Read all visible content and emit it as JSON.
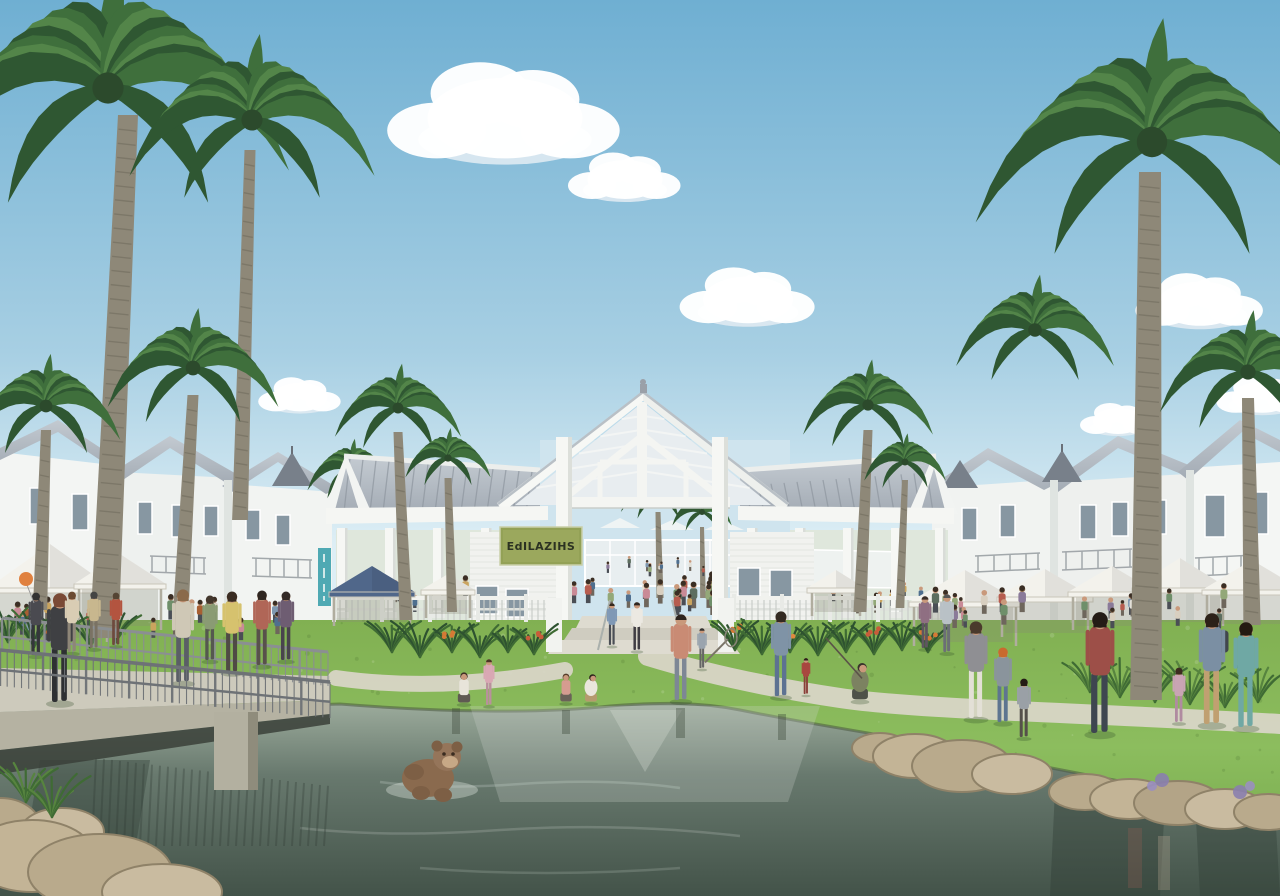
{
  "sign": {
    "text": "EdILAZIHS",
    "bg": "#93a156",
    "border": "#6d7a3c",
    "text_color": "#2c3222"
  },
  "banner": {
    "color": "#4fa9b3"
  },
  "palette": {
    "sky_top": "#6fafd2",
    "sky_mid": "#a7cfe3",
    "sky_low": "#ddeef5",
    "cloud": "#ffffff",
    "cloud_shade": "#dfeaf2",
    "grass_light": "#8cbd5e",
    "grass": "#6fa348",
    "grass_dark": "#56893a",
    "path": "#d8d5c6",
    "water_top": "#a3b2a2",
    "water_mid": "#68796e",
    "water_low": "#435349",
    "roof": "#b4bbc3",
    "roof_seam": "#8e969f",
    "wall_white": "#f5f6f4",
    "wall_shade": "#e2e6e3",
    "window": "#8797a2",
    "trunk": "#8e8878",
    "trunk_dark": "#6f6a5c",
    "palm_dark": "#2f5732",
    "palm_mid": "#3f6f3c",
    "palm_light": "#538549",
    "tent_white": "#f3f2ec",
    "tent_blue": "#50678a",
    "rock": "#b9aa8c",
    "rock_dark": "#8f8268",
    "concrete": "#cdcabc",
    "railing": "#7e8286",
    "skin": "#c9997b"
  },
  "clouds": [
    {
      "cx": 505,
      "cy": 115,
      "s": 1.55
    },
    {
      "cx": 625,
      "cy": 178,
      "s": 0.75
    },
    {
      "cx": 748,
      "cy": 298,
      "s": 0.9
    },
    {
      "cx": 300,
      "cy": 396,
      "s": 0.55
    },
    {
      "cx": 1200,
      "cy": 302,
      "s": 0.85
    },
    {
      "cx": 1262,
      "cy": 396,
      "s": 0.6
    },
    {
      "cx": 1118,
      "cy": 420,
      "s": 0.5
    }
  ],
  "palms": [
    {
      "cx": 108,
      "cy": 88,
      "r": 195,
      "trunk": {
        "tx": 128,
        "ty": 115,
        "bx": 104,
        "by": 638,
        "w": 20
      },
      "layer": "front"
    },
    {
      "cx": 252,
      "cy": 120,
      "r": 132,
      "trunk": {
        "tx": 250,
        "ty": 150,
        "bx": 240,
        "by": 520,
        "w": 11
      },
      "layer": "front"
    },
    {
      "cx": 193,
      "cy": 368,
      "r": 92,
      "trunk": {
        "tx": 193,
        "ty": 395,
        "bx": 180,
        "by": 625,
        "w": 11
      },
      "layer": "front"
    },
    {
      "cx": 46,
      "cy": 406,
      "r": 80,
      "trunk": {
        "tx": 46,
        "ty": 430,
        "bx": 40,
        "by": 610,
        "w": 10
      },
      "layer": "front"
    },
    {
      "cx": 398,
      "cy": 408,
      "r": 68,
      "trunk": {
        "tx": 398,
        "ty": 432,
        "bx": 406,
        "by": 620,
        "w": 9
      },
      "layer": "front"
    },
    {
      "cx": 448,
      "cy": 458,
      "r": 46,
      "trunk": {
        "tx": 448,
        "ty": 478,
        "bx": 452,
        "by": 612,
        "w": 7
      },
      "layer": "front"
    },
    {
      "cx": 868,
      "cy": 405,
      "r": 70,
      "trunk": {
        "tx": 868,
        "ty": 430,
        "bx": 860,
        "by": 612,
        "w": 9
      },
      "layer": "front"
    },
    {
      "cx": 905,
      "cy": 462,
      "r": 44,
      "trunk": {
        "tx": 905,
        "ty": 480,
        "bx": 900,
        "by": 608,
        "w": 6
      },
      "layer": "front"
    },
    {
      "cx": 1152,
      "cy": 142,
      "r": 190,
      "trunk": {
        "tx": 1150,
        "ty": 172,
        "bx": 1146,
        "by": 700,
        "w": 22
      },
      "layer": "front"
    },
    {
      "cx": 1248,
      "cy": 372,
      "r": 95,
      "trunk": {
        "tx": 1248,
        "ty": 398,
        "bx": 1252,
        "by": 625,
        "w": 12
      },
      "layer": "front"
    },
    {
      "cx": 1035,
      "cy": 330,
      "r": 85,
      "trunk": null,
      "layer": "backA"
    },
    {
      "cx": 352,
      "cy": 470,
      "r": 48,
      "trunk": null,
      "layer": "backB"
    },
    {
      "cx": 658,
      "cy": 495,
      "r": 40,
      "trunk": {
        "tx": 658,
        "ty": 512,
        "bx": 660,
        "by": 598,
        "w": 5
      },
      "layer": "mid"
    },
    {
      "cx": 702,
      "cy": 512,
      "r": 32,
      "trunk": {
        "tx": 702,
        "ty": 527,
        "bx": 703,
        "by": 598,
        "w": 4
      },
      "layer": "mid"
    }
  ],
  "tents": [
    {
      "cx": 50,
      "y": 588,
      "w": 124,
      "rise": 44,
      "legH": 54,
      "row": "left"
    },
    {
      "cx": 120,
      "y": 584,
      "w": 92,
      "rise": 30,
      "legH": 46,
      "row": "left"
    },
    {
      "cx": 372,
      "y": 592,
      "w": 86,
      "rise": 26,
      "legH": 34,
      "row": "left",
      "color": "#50678a"
    },
    {
      "cx": 448,
      "y": 590,
      "w": 54,
      "rise": 16,
      "legH": 28,
      "row": "left"
    },
    {
      "cx": 836,
      "y": 588,
      "w": 58,
      "rise": 18,
      "legH": 28,
      "row": "right"
    },
    {
      "cx": 965,
      "y": 602,
      "w": 112,
      "rise": 32,
      "legH": 44,
      "row": "right"
    },
    {
      "cx": 1045,
      "y": 597,
      "w": 96,
      "rise": 28,
      "legH": 40,
      "row": "right"
    },
    {
      "cx": 1112,
      "y": 592,
      "w": 88,
      "rise": 26,
      "legH": 38,
      "row": "right"
    },
    {
      "cx": 1180,
      "y": 588,
      "w": 96,
      "rise": 30,
      "legH": 38,
      "row": "right"
    },
    {
      "cx": 1252,
      "y": 590,
      "w": 100,
      "rise": 30,
      "legH": 38,
      "row": "right"
    }
  ],
  "crowds": [
    {
      "layer": "distant",
      "x": 598,
      "y": 560,
      "w": 124,
      "h": 18,
      "n": 10,
      "hmin": 8,
      "hmax": 13,
      "seed": 11
    },
    {
      "layer": "pavilion",
      "x": 562,
      "y": 582,
      "w": 170,
      "h": 34,
      "n": 22,
      "hmin": 16,
      "hmax": 26,
      "seed": 3
    },
    {
      "layer": "pavilion",
      "x": 346,
      "y": 588,
      "w": 196,
      "h": 28,
      "n": 14,
      "hmin": 14,
      "hmax": 24,
      "seed": 5
    },
    {
      "layer": "pavilion",
      "x": 742,
      "y": 586,
      "w": 196,
      "h": 28,
      "n": 14,
      "hmin": 14,
      "hmax": 24,
      "seed": 7
    },
    {
      "layer": "tents",
      "x": 4,
      "y": 600,
      "w": 150,
      "h": 44,
      "n": 12,
      "hmin": 18,
      "hmax": 30,
      "seed": 13
    },
    {
      "layer": "tents",
      "x": 160,
      "y": 602,
      "w": 170,
      "h": 40,
      "n": 10,
      "hmin": 16,
      "hmax": 26,
      "seed": 17
    },
    {
      "layer": "tents",
      "x": 935,
      "y": 588,
      "w": 340,
      "h": 42,
      "n": 26,
      "hmin": 14,
      "hmax": 26,
      "seed": 19
    }
  ],
  "crowd_palette": [
    "#b65c4e",
    "#7f98b0",
    "#d8cfc0",
    "#6f8f6a",
    "#caa45e",
    "#8a7a99",
    "#e3e0d8",
    "#4f6f8f",
    "#a85f32",
    "#93a878",
    "#c98a96",
    "#5d6e5f"
  ],
  "people": [
    {
      "x": 60,
      "y": 702,
      "h": 108,
      "shirt": "#3f4043",
      "pants": "#2e3033",
      "hair": "#7a4a36",
      "type": "walk",
      "layer": "bridge"
    },
    {
      "x": 36,
      "y": 655,
      "h": 62,
      "shirt": "#4a4a50",
      "pants": "#35363b",
      "hair": "#333333",
      "type": "walk",
      "layer": "bridge",
      "prop": "balloon",
      "propColor": "#e0813f"
    },
    {
      "x": 72,
      "y": 652,
      "h": 60,
      "shirt": "#d9cdb4",
      "pants": "#8e8678",
      "hair": "#6b4a33",
      "type": "walk",
      "layer": "bridge"
    },
    {
      "x": 94,
      "y": 648,
      "h": 56,
      "shirt": "#c8b78e",
      "pants": "#7a7264",
      "hair": "#444444",
      "type": "walk",
      "layer": "bridge"
    },
    {
      "x": 116,
      "y": 645,
      "h": 52,
      "shirt": "#b3543f",
      "pants": "#6e4a3e",
      "hair": "#554433",
      "type": "walk",
      "layer": "bridge"
    },
    {
      "x": 183,
      "y": 682,
      "h": 92,
      "shirt": "#cfc8b6",
      "pants": "#5a5e66",
      "hair": "#8a6a4a",
      "type": "walk",
      "layer": "bridge"
    },
    {
      "x": 232,
      "y": 672,
      "h": 80,
      "shirt": "#d6c26e",
      "pants": "#4f4a45",
      "hair": "#3a2c22",
      "type": "walk",
      "layer": "bridge"
    },
    {
      "x": 262,
      "y": 665,
      "h": 74,
      "shirt": "#b06657",
      "pants": "#58514b",
      "hair": "#2f2620",
      "type": "walk",
      "layer": "bridge"
    },
    {
      "x": 286,
      "y": 660,
      "h": 68,
      "shirt": "#6e5d72",
      "pants": "#49434d",
      "hair": "#332a26",
      "type": "walk",
      "layer": "bridge"
    },
    {
      "x": 210,
      "y": 660,
      "h": 64,
      "shirt": "#8a9b74",
      "pants": "#55584f",
      "hair": "#42362c",
      "type": "walk",
      "layer": "bridge"
    },
    {
      "x": 464,
      "y": 703,
      "h": 56,
      "shirt": "#e8e4da",
      "pants": "#5f5a52",
      "hair": "#3c2e24",
      "type": "kneel"
    },
    {
      "x": 489,
      "y": 705,
      "h": 46,
      "shirt": "#d9a8b4",
      "pants": "#b9909c",
      "hair": "#4a3526",
      "type": "stand"
    },
    {
      "x": 566,
      "y": 702,
      "h": 52,
      "shirt": "#d59c90",
      "pants": "#6a6258",
      "hair": "#553c28",
      "type": "kneel"
    },
    {
      "x": 591,
      "y": 702,
      "h": 54,
      "shirt": "#eae6dc",
      "pants": "#b59a6e",
      "hair": "#2e241c",
      "type": "crouch"
    },
    {
      "x": 681,
      "y": 700,
      "h": 86,
      "shirt": "#c98b74",
      "pants": "#7d8795",
      "hair": "#2d241e",
      "type": "front"
    },
    {
      "x": 702,
      "y": 668,
      "h": 40,
      "shirt": "#9aa4ae",
      "pants": "#666666",
      "hair": "#333333",
      "type": "stand",
      "prop": "net"
    },
    {
      "x": 637,
      "y": 650,
      "h": 48,
      "shirt": "#ece9e2",
      "pants": "#3f3c42",
      "hair": "#2e2620",
      "type": "front"
    },
    {
      "x": 612,
      "y": 645,
      "h": 42,
      "shirt": "#7f98b5",
      "pants": "#4a4e55",
      "hair": "#35291f",
      "type": "front"
    },
    {
      "x": 781,
      "y": 696,
      "h": 84,
      "shirt": "#7f93a6",
      "pants": "#5d7292",
      "hair": "#332a22",
      "type": "walk"
    },
    {
      "x": 806,
      "y": 694,
      "h": 36,
      "shirt": "#a8473f",
      "pants": "#8a3f38",
      "hair": "#2c1f18",
      "type": "stand"
    },
    {
      "x": 860,
      "y": 700,
      "h": 72,
      "shirt": "#7c8261",
      "pants": "#4e5149",
      "hair": "#39332c",
      "type": "crouch",
      "prop": "rod"
    },
    {
      "x": 976,
      "y": 718,
      "h": 96,
      "shirt": "#8f8f93",
      "pants": "#e3e0d6",
      "hair": "#4a3a2c",
      "type": "walk"
    },
    {
      "x": 1003,
      "y": 722,
      "h": 74,
      "shirt": "#8a949c",
      "pants": "#5e7590",
      "hair": "#c96a2e",
      "type": "walk"
    },
    {
      "x": 1024,
      "y": 737,
      "h": 58,
      "shirt": "#9aa0a6",
      "pants": "#55504a",
      "hair": "#241c16",
      "type": "walk"
    },
    {
      "x": 1100,
      "y": 733,
      "h": 120,
      "shirt": "#9d4f48",
      "pants": "#3e4650",
      "hair": "#241c16",
      "type": "walk"
    },
    {
      "x": 1179,
      "y": 722,
      "h": 54,
      "shirt": "#c9a4b4",
      "pants": "#b08ba0",
      "hair": "#3c2c20",
      "type": "walk"
    },
    {
      "x": 1212,
      "y": 724,
      "h": 110,
      "shirt": "#7b8fa3",
      "pants": "#c0a071",
      "hair": "#2c2118",
      "type": "walk",
      "prop": "backpack"
    },
    {
      "x": 1246,
      "y": 727,
      "h": 104,
      "shirt": "#6fa8a4",
      "pants": "#6fa8a4",
      "hair": "#241a12",
      "type": "walk"
    },
    {
      "x": 947,
      "y": 652,
      "h": 58,
      "shirt": "#b9c1c6",
      "pants": "#6b6f75",
      "hair": "#555555",
      "type": "stand"
    },
    {
      "x": 925,
      "y": 648,
      "h": 52,
      "shirt": "#8f6f82",
      "pants": "#5f5560",
      "hair": "#3a2f28",
      "type": "stand"
    }
  ],
  "plants": [
    {
      "x": 392,
      "y": 652,
      "s": 26
    },
    {
      "x": 420,
      "y": 657,
      "s": 30
    },
    {
      "x": 452,
      "y": 652,
      "s": 24,
      "f": "#d57a35"
    },
    {
      "x": 480,
      "y": 657,
      "s": 28
    },
    {
      "x": 508,
      "y": 652,
      "s": 22
    },
    {
      "x": 534,
      "y": 654,
      "s": 26,
      "f": "#c85c3a"
    },
    {
      "x": 735,
      "y": 650,
      "s": 28,
      "f": "#d57a35"
    },
    {
      "x": 762,
      "y": 654,
      "s": 30
    },
    {
      "x": 790,
      "y": 652,
      "s": 24,
      "f": "#e08a3f"
    },
    {
      "x": 818,
      "y": 655,
      "s": 28
    },
    {
      "x": 846,
      "y": 652,
      "s": 26
    },
    {
      "x": 874,
      "y": 654,
      "s": 30,
      "f": "#c85c3a"
    },
    {
      "x": 902,
      "y": 650,
      "s": 24
    },
    {
      "x": 928,
      "y": 652,
      "s": 22,
      "f": "#d57a35"
    },
    {
      "x": 8,
      "y": 642,
      "s": 30
    },
    {
      "x": 34,
      "y": 647,
      "s": 34
    },
    {
      "x": 62,
      "y": 644,
      "s": 28
    },
    {
      "x": 90,
      "y": 647,
      "s": 30
    },
    {
      "x": 116,
      "y": 642,
      "s": 26
    },
    {
      "x": 1090,
      "y": 692,
      "s": 30
    },
    {
      "x": 1120,
      "y": 697,
      "s": 34
    },
    {
      "x": 1155,
      "y": 702,
      "s": 30
    },
    {
      "x": 1190,
      "y": 704,
      "s": 36
    },
    {
      "x": 1225,
      "y": 707,
      "s": 32
    },
    {
      "x": 1258,
      "y": 702,
      "s": 30
    },
    {
      "x": 26,
      "y": 802,
      "s": 40
    },
    {
      "x": 52,
      "y": 817,
      "s": 36
    }
  ],
  "floating_toy": {
    "body": "#8a6a4e",
    "head": "#95755a",
    "muzzle": "#c7a886"
  }
}
